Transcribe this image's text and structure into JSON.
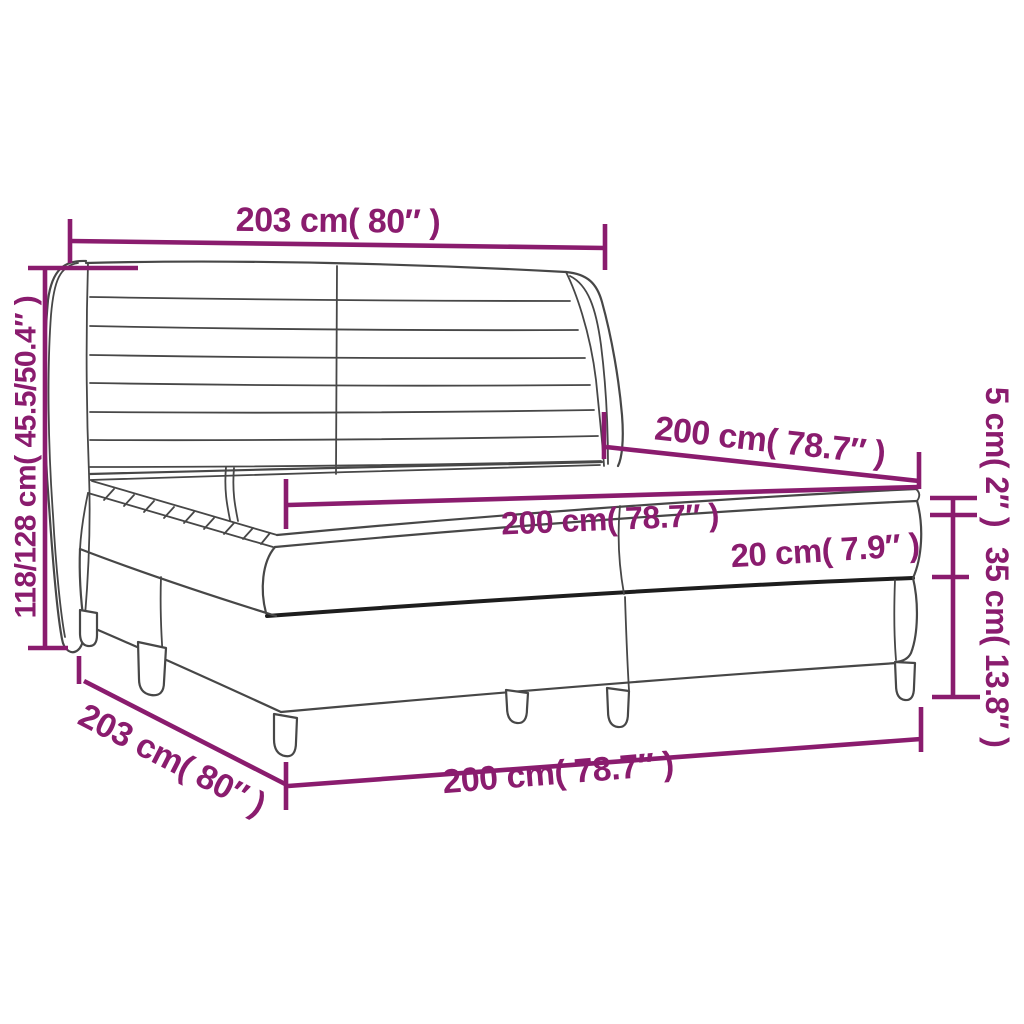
{
  "diagram": {
    "type": "product-dimension-diagram",
    "subject": "box-spring-bed-with-wing-headboard",
    "colors": {
      "dimension_accent": "#8a1c6e",
      "drawing_line": "#474747",
      "drawing_line_dark": "#1d1d1d",
      "background": "#ffffff"
    },
    "labels": {
      "headboard_width": "203 cm( 80″ )",
      "total_height": "118/128 cm( 45.5/50.4″ )",
      "bed_depth_top": "200 cm( 78.7″ )",
      "mattress_width": "200 cm( 78.7″ )",
      "mattress_height": "20 cm( 7.9″ )",
      "topper_height": "5 cm( 2″ )",
      "box_height": "35 cm( 13.8″ )",
      "frame_depth_bottom": "203 cm( 80″ )",
      "frame_width_bottom": "200 cm( 78.7″ )"
    }
  }
}
